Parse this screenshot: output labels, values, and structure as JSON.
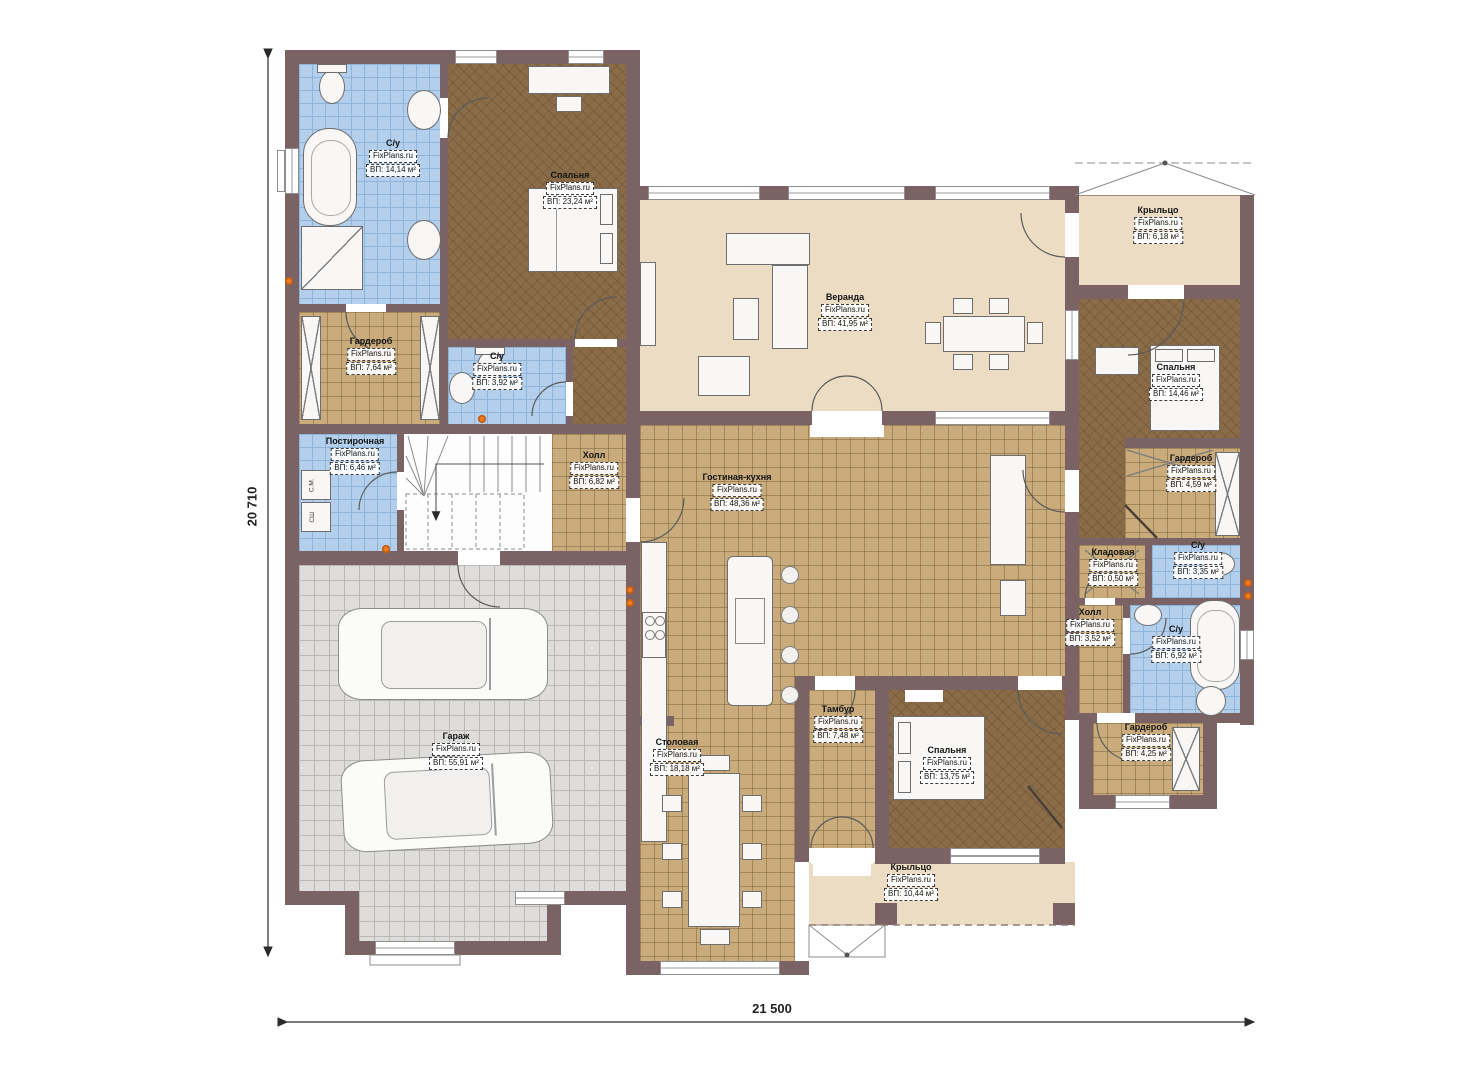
{
  "brand": "FixPlans.ru",
  "dimensions": {
    "width": "21 500",
    "height": "20 710"
  },
  "appliances": {
    "washing_machine": "С.М.",
    "dryer": "СШ"
  },
  "rooms": [
    {
      "name": "С/у",
      "brand": "FixPlans.ru",
      "area": "ВП: 14,14 м²"
    },
    {
      "name": "Спальня",
      "brand": "FixPlans.ru",
      "area": "ВП: 23,24 м²"
    },
    {
      "name": "Гардероб",
      "brand": "FixPlans.ru",
      "area": "ВП: 7,64 м²"
    },
    {
      "name": "С/у",
      "brand": "FixPlans.ru",
      "area": "ВП: 3,92 м²"
    },
    {
      "name": "Постирочная",
      "brand": "FixPlans.ru",
      "area": "ВП: 6,46 м²"
    },
    {
      "name": "Холл",
      "brand": "FixPlans.ru",
      "area": "ВП: 6,82 м²"
    },
    {
      "name": "Веранда",
      "brand": "FixPlans.ru",
      "area": "ВП: 41,95 м²"
    },
    {
      "name": "Гостиная-кухня",
      "brand": "FixPlans.ru",
      "area": "ВП: 48,36 м²"
    },
    {
      "name": "Гараж",
      "brand": "FixPlans.ru",
      "area": "ВП: 55,91 м²"
    },
    {
      "name": "Столовая",
      "brand": "FixPlans.ru",
      "area": "ВП: 18,18 м²"
    },
    {
      "name": "Тамбур",
      "brand": "FixPlans.ru",
      "area": "ВП: 7,48 м²"
    },
    {
      "name": "Спальня",
      "brand": "FixPlans.ru",
      "area": "ВП: 13,75 м²"
    },
    {
      "name": "Крыльцо",
      "brand": "FixPlans.ru",
      "area": "ВП: 10,44 м²"
    },
    {
      "name": "Крыльцо",
      "brand": "FixPlans.ru",
      "area": "ВП: 6,18 м²"
    },
    {
      "name": "Спальня",
      "brand": "FixPlans.ru",
      "area": "ВП: 14,46 м²"
    },
    {
      "name": "Гардероб",
      "brand": "FixPlans.ru",
      "area": "ВП: 4,59 м²"
    },
    {
      "name": "Кладовая",
      "brand": "FixPlans.ru",
      "area": "ВП: 0,50 м²"
    },
    {
      "name": "С/у",
      "brand": "FixPlans.ru",
      "area": "ВП: 3,35 м²"
    },
    {
      "name": "Холл",
      "brand": "FixPlans.ru",
      "area": "ВП: 3,52 м²"
    },
    {
      "name": "С/у",
      "brand": "FixPlans.ru",
      "area": "ВП: 6,92 м²"
    },
    {
      "name": "Гардероб",
      "brand": "FixPlans.ru",
      "area": "ВП: 4,25 м²"
    }
  ]
}
